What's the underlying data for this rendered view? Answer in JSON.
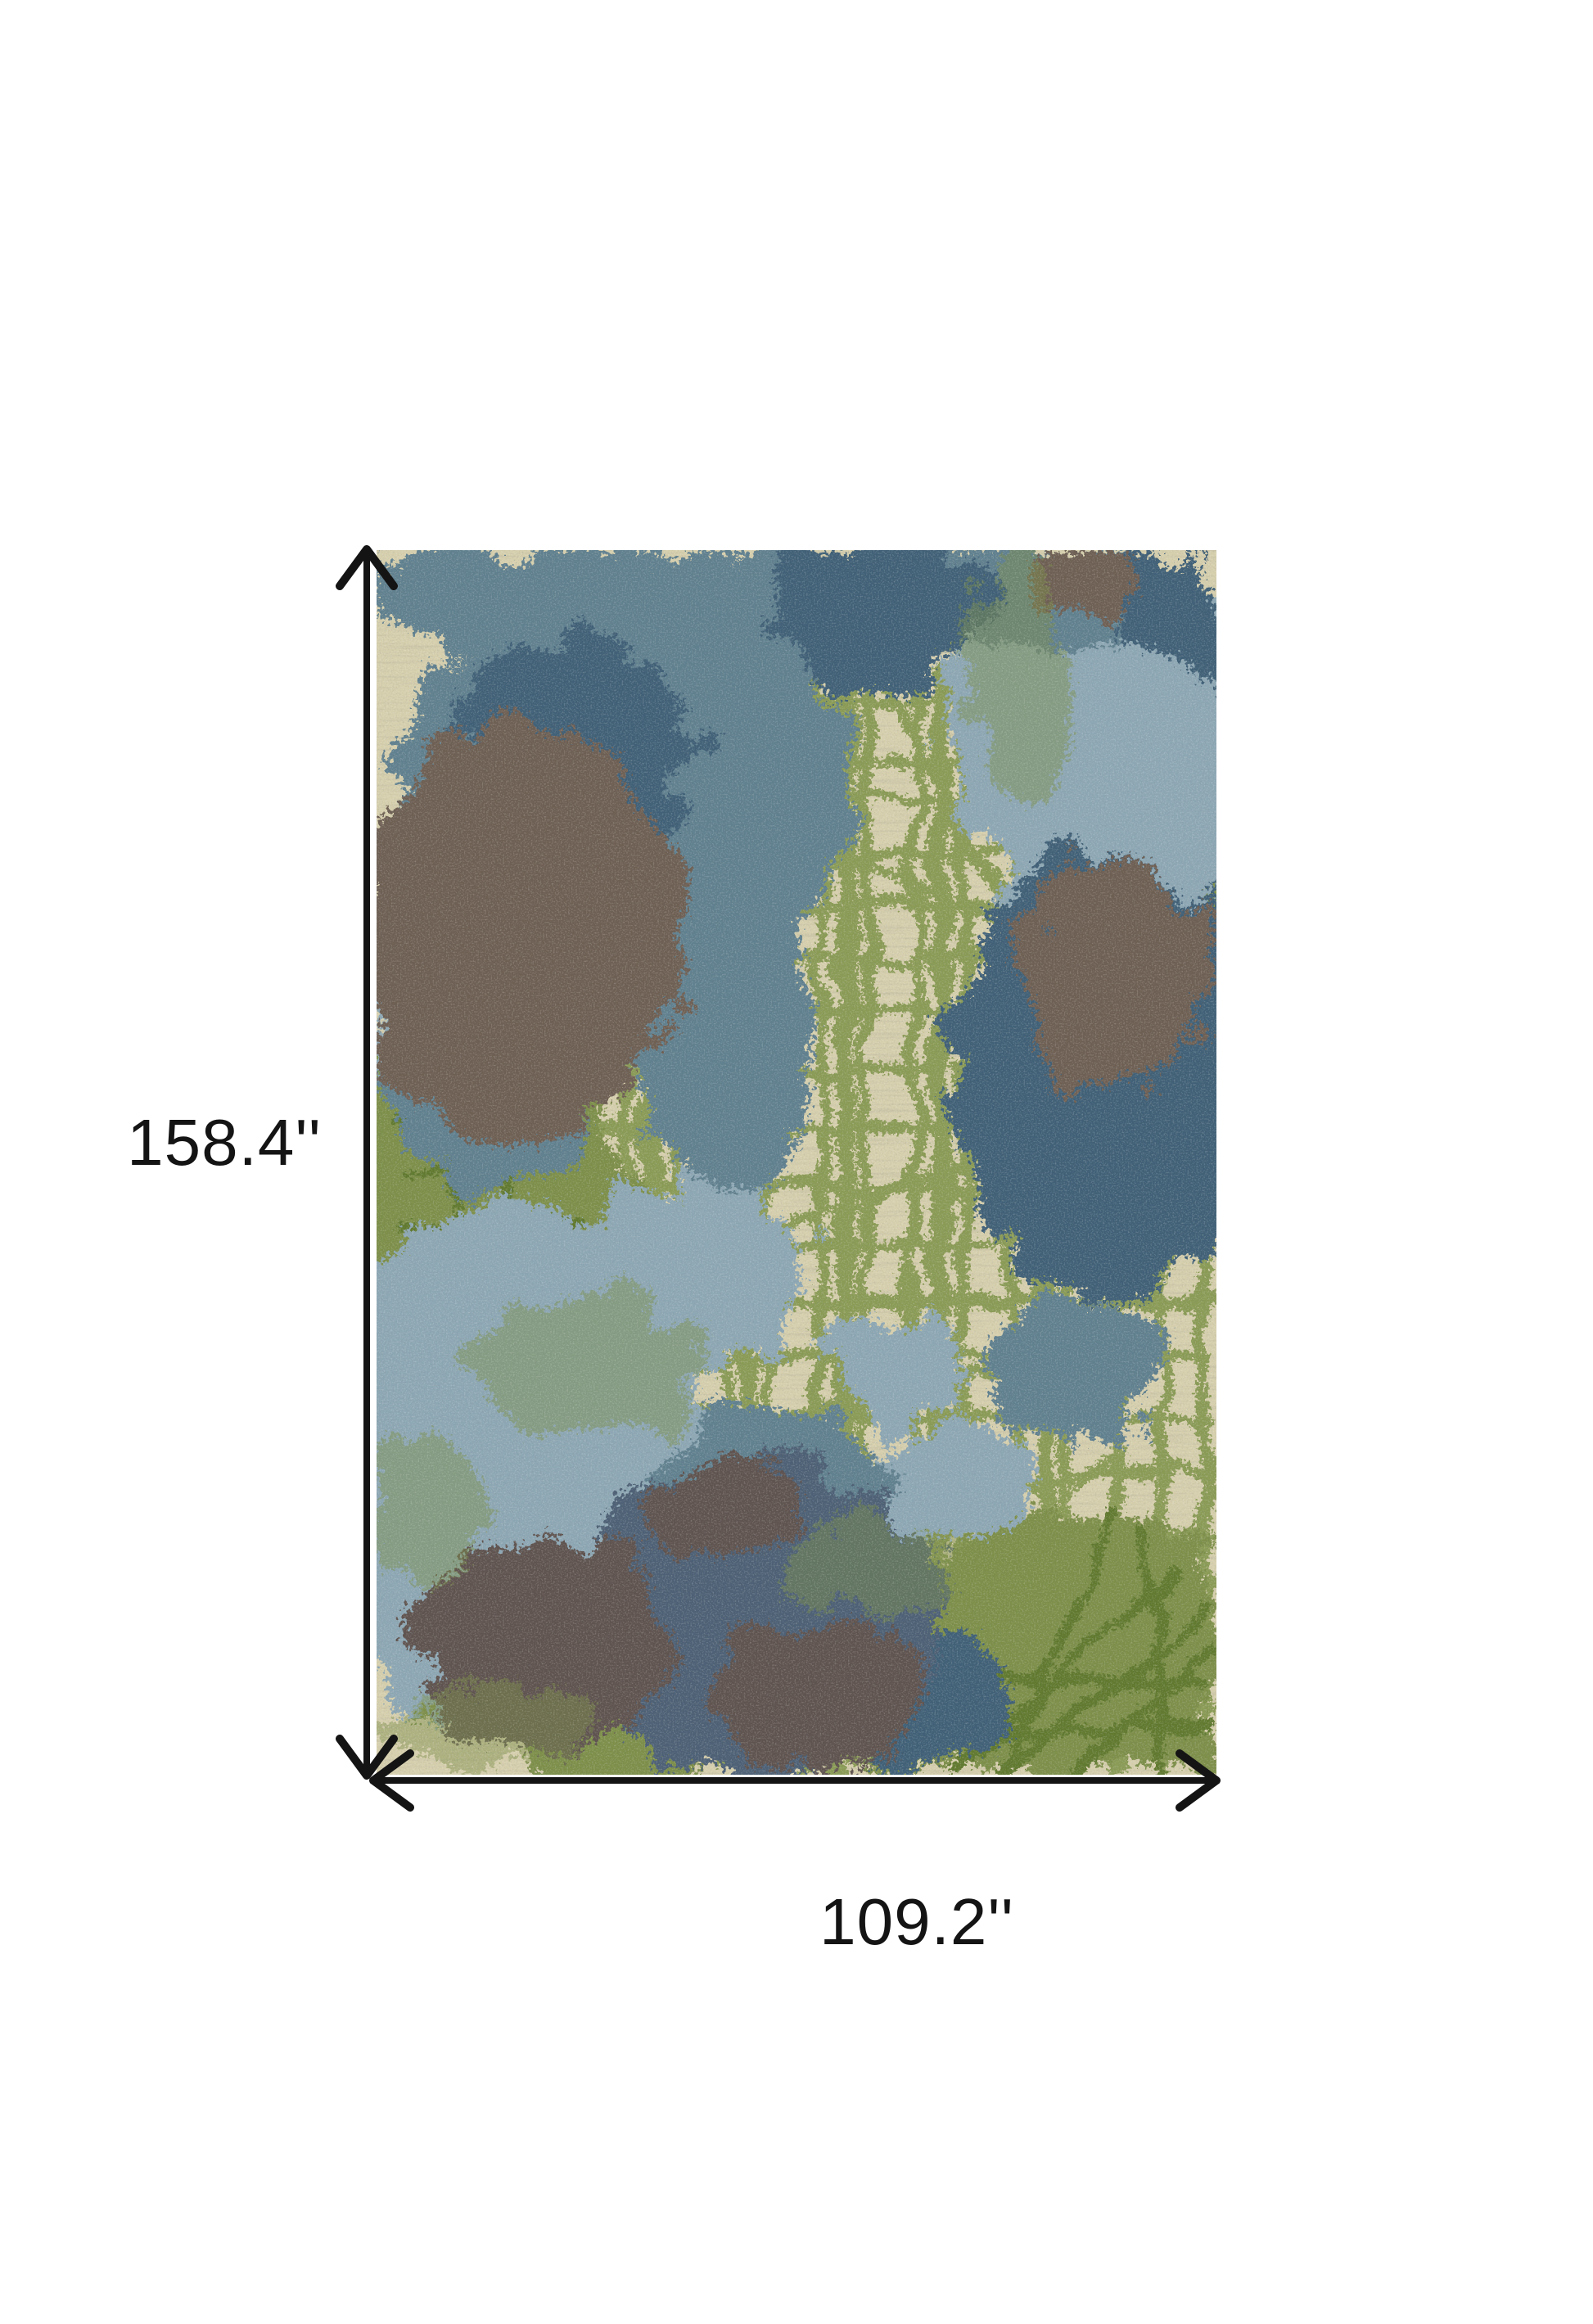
{
  "figure": {
    "type": "product-dimension-diagram",
    "item": "abstract-area-rug",
    "height_label": "158.4''",
    "width_label": "109.2''"
  },
  "palette": {
    "page-bg": "#ffffff",
    "annotation-ink": "#141414",
    "rug-beige": "#d7d0ae",
    "rug-stitch": "#6f6850",
    "rug-grid-green": "#8a9b55",
    "rug-green": "#7d8f49",
    "rug-green-dark": "#60792f",
    "rug-blue-light": "#8da7b4",
    "rug-blue-steel": "#60808f",
    "rug-blue-dark": "#406077",
    "rug-slate": "#4d6175",
    "rug-brown": "#6e5e53",
    "rug-brown-gray": "#5e534f"
  }
}
